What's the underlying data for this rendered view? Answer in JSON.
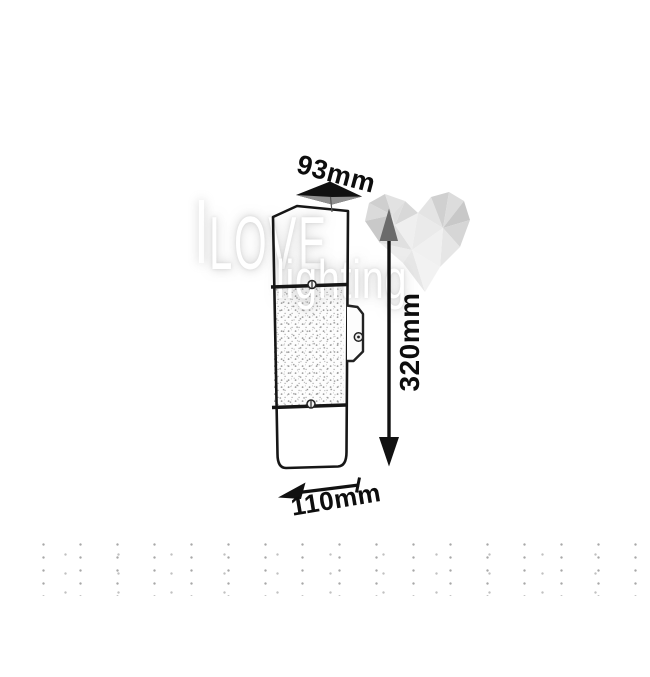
{
  "dimensions": {
    "width_top": "93mm",
    "height_side": "320mm",
    "depth_bottom": "110mm"
  },
  "watermark": {
    "title": "LOVE",
    "subtitle": "lighting"
  },
  "icons": {
    "width_arrow": "perspective-double-arrow-icon",
    "height_arrow": "vertical-double-headed-arrow-icon",
    "depth_arrow": "left-arrow-with-end-tick-icon",
    "heart": "lowpoly-heart-watermark-icon",
    "screws": "slot-screw-icon"
  },
  "colors": {
    "background": "#ffffff",
    "ink": "#161616",
    "dimension_text": "#0d0d0d",
    "watermark_text": "#ffffff",
    "heart_light": "#f0f0f0",
    "heart_dark": "#c8c8c8",
    "shaded_arrow_face": "#909090"
  }
}
